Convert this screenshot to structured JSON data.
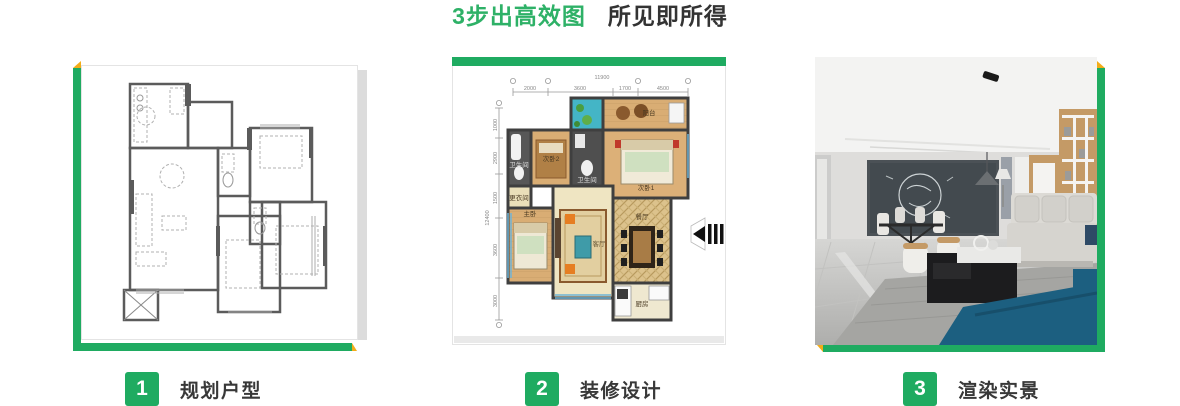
{
  "title": {
    "highlight": "3步出高效图",
    "rest": "所见即所得"
  },
  "steps": [
    {
      "number": "1",
      "label": "规划户型"
    },
    {
      "number": "2",
      "label": "装修设计"
    },
    {
      "number": "3",
      "label": "渲染实景"
    }
  ],
  "panels": {
    "design": {
      "dims_top_total": "11900",
      "dims_top": [
        "2000",
        "3600",
        "1700",
        "4500"
      ],
      "dims_left_total": "12400",
      "dims_left": [
        "1000",
        "2900",
        "1500",
        "3600",
        "3000"
      ],
      "rooms": {
        "balcony": "阳台",
        "bedroom1": "次卧1",
        "bedroom2": "次卧2",
        "bath1": "卫生间",
        "bath2": "卫生间",
        "closet": "更衣间",
        "master": "主卧",
        "living": "客厅",
        "dining": "餐厅",
        "kitchen": "厨房"
      }
    }
  },
  "colors": {
    "accent_green": "#1fab61",
    "accent_yellow": "#f3ac19",
    "title_green": "#2eb167",
    "text_dark": "#333333"
  }
}
